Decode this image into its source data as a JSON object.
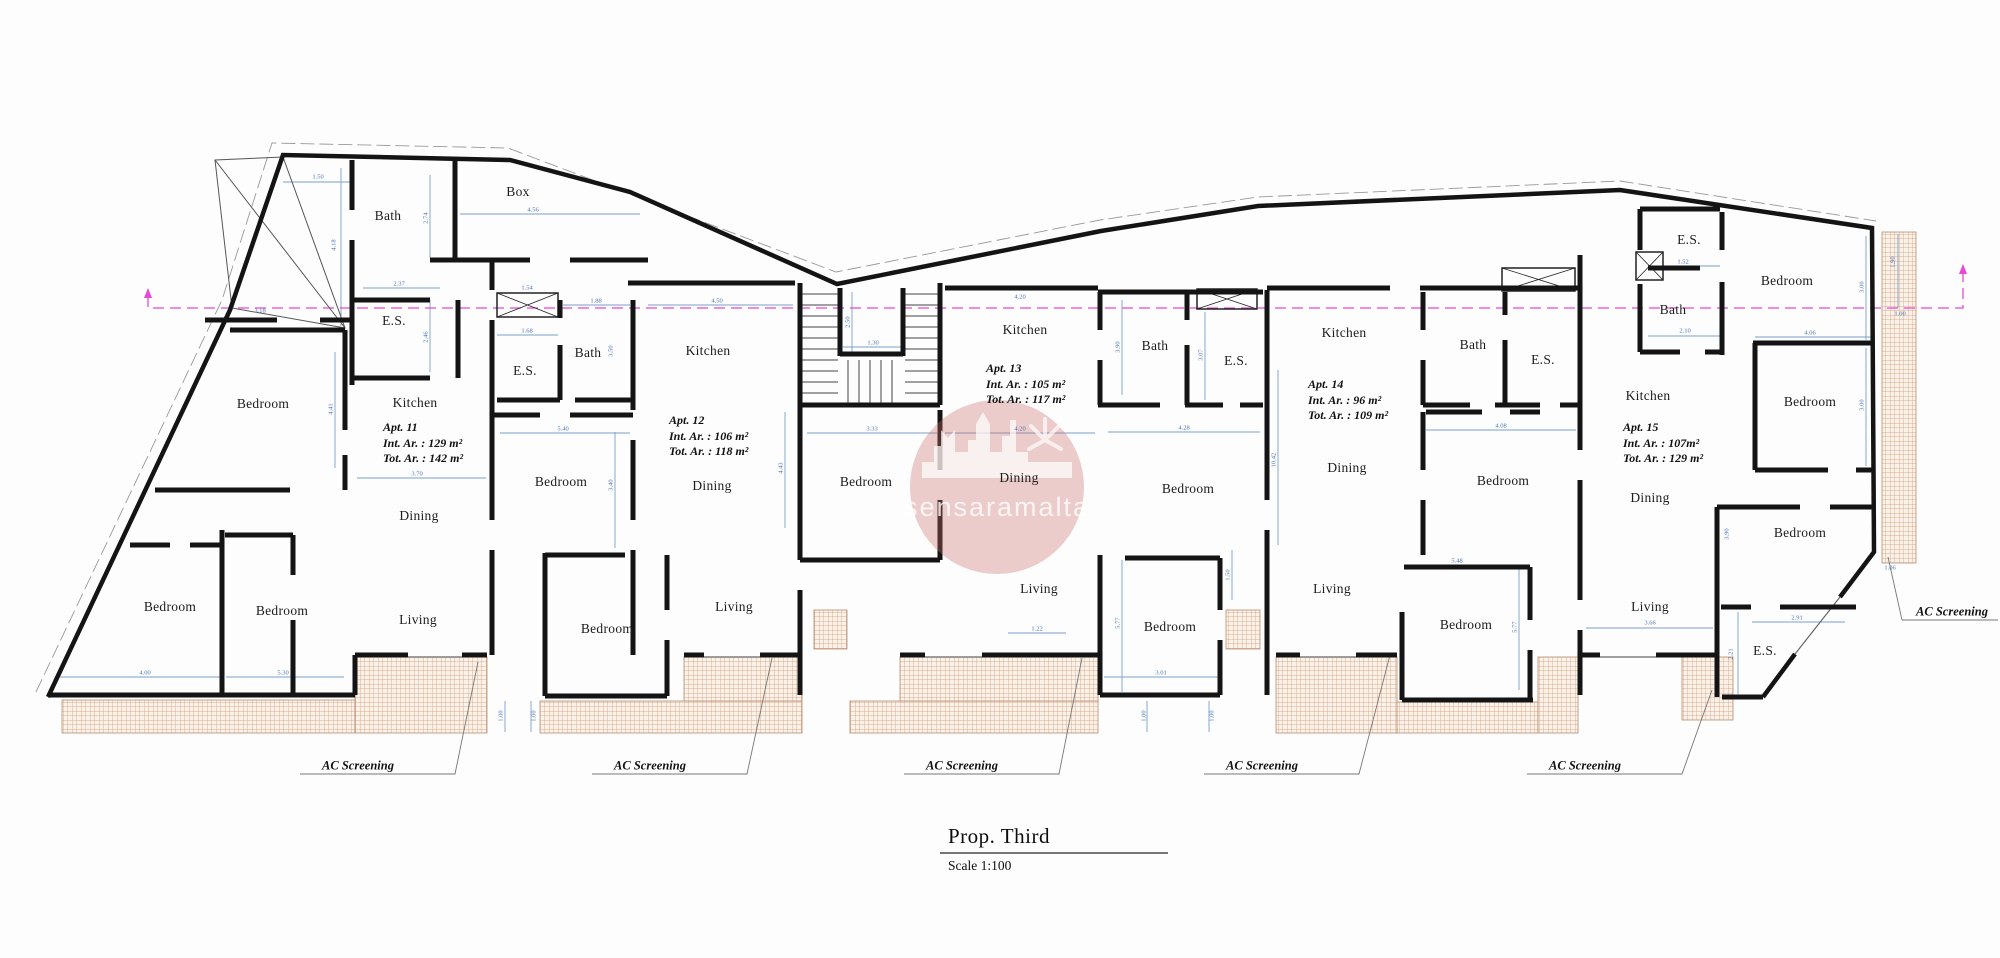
{
  "title_block": {
    "title": "Prop. Third",
    "scale": "Scale 1:100"
  },
  "watermark": {
    "text": "sensaramalta",
    "circle_color": "#c96a6a"
  },
  "colors": {
    "wall": "#141414",
    "dimension": "#4a76b8",
    "datum_magenta": "#e649d6",
    "terrace_hatch": "#cf9b76"
  },
  "apartments": [
    {
      "name": "Apt. 11",
      "int_area": "Int. Ar. : 129 m²",
      "tot_area": "Tot. Ar. : 142 m²",
      "x": 383,
      "y": 420
    },
    {
      "name": "Apt. 12",
      "int_area": "Int. Ar. : 106 m²",
      "tot_area": "Tot. Ar. : 118 m²",
      "x": 669,
      "y": 413
    },
    {
      "name": "Apt. 13",
      "int_area": "Int. Ar. : 105 m²",
      "tot_area": "Tot. Ar. : 117 m²",
      "x": 986,
      "y": 361
    },
    {
      "name": "Apt. 14",
      "int_area": "Int. Ar. : 96 m²",
      "tot_area": "Tot. Ar. : 109 m²",
      "x": 1308,
      "y": 377
    },
    {
      "name": "Apt. 15",
      "int_area": "Int. Ar. : 107m²",
      "tot_area": "Tot. Ar. : 129 m²",
      "x": 1623,
      "y": 420
    }
  ],
  "rooms": [
    {
      "label": "Bath",
      "x": 388,
      "y": 216
    },
    {
      "label": "Box",
      "x": 518,
      "y": 192
    },
    {
      "label": "E.S.",
      "x": 394,
      "y": 321
    },
    {
      "label": "Bedroom",
      "x": 263,
      "y": 404
    },
    {
      "label": "Kitchen",
      "x": 415,
      "y": 403
    },
    {
      "label": "Dining",
      "x": 419,
      "y": 516
    },
    {
      "label": "Bedroom",
      "x": 170,
      "y": 607
    },
    {
      "label": "Bedroom",
      "x": 282,
      "y": 611
    },
    {
      "label": "Living",
      "x": 418,
      "y": 620
    },
    {
      "label": "Bath",
      "x": 588,
      "y": 353
    },
    {
      "label": "E.S.",
      "x": 525,
      "y": 371
    },
    {
      "label": "Kitchen",
      "x": 708,
      "y": 351
    },
    {
      "label": "Bedroom",
      "x": 561,
      "y": 482
    },
    {
      "label": "Dining",
      "x": 712,
      "y": 486
    },
    {
      "label": "Bedroom",
      "x": 607,
      "y": 629
    },
    {
      "label": "Living",
      "x": 734,
      "y": 607
    },
    {
      "label": "Kitchen",
      "x": 1025,
      "y": 330
    },
    {
      "label": "Bedroom",
      "x": 866,
      "y": 482
    },
    {
      "label": "Dining",
      "x": 1019,
      "y": 478
    },
    {
      "label": "Bath",
      "x": 1155,
      "y": 346
    },
    {
      "label": "E.S.",
      "x": 1236,
      "y": 361
    },
    {
      "label": "Living",
      "x": 1039,
      "y": 589
    },
    {
      "label": "Bedroom",
      "x": 1170,
      "y": 627
    },
    {
      "label": "Kitchen",
      "x": 1344,
      "y": 333
    },
    {
      "label": "Bath",
      "x": 1473,
      "y": 345
    },
    {
      "label": "E.S.",
      "x": 1543,
      "y": 360
    },
    {
      "label": "Bedroom",
      "x": 1188,
      "y": 489
    },
    {
      "label": "Dining",
      "x": 1347,
      "y": 468
    },
    {
      "label": "Living",
      "x": 1332,
      "y": 589
    },
    {
      "label": "Bedroom",
      "x": 1466,
      "y": 625
    },
    {
      "label": "Kitchen",
      "x": 1648,
      "y": 396
    },
    {
      "label": "Bath",
      "x": 1673,
      "y": 310
    },
    {
      "label": "E.S.",
      "x": 1689,
      "y": 240
    },
    {
      "label": "Bedroom",
      "x": 1787,
      "y": 281
    },
    {
      "label": "Bedroom",
      "x": 1810,
      "y": 402
    },
    {
      "label": "Bedroom",
      "x": 1503,
      "y": 481
    },
    {
      "label": "Dining",
      "x": 1650,
      "y": 498
    },
    {
      "label": "Living",
      "x": 1650,
      "y": 607
    },
    {
      "label": "Bedroom",
      "x": 1800,
      "y": 533
    },
    {
      "label": "E.S.",
      "x": 1765,
      "y": 651
    }
  ],
  "ac_screening_labels": [
    {
      "label": "AC Screening",
      "x": 358,
      "y": 766
    },
    {
      "label": "AC Screening",
      "x": 650,
      "y": 766
    },
    {
      "label": "AC Screening",
      "x": 962,
      "y": 766
    },
    {
      "label": "AC Screening",
      "x": 1262,
      "y": 766
    },
    {
      "label": "AC Screening",
      "x": 1585,
      "y": 766
    },
    {
      "label": "AC Screening",
      "x": 1952,
      "y": 612
    }
  ],
  "dimensions": [
    {
      "v": "1.50",
      "x": 318,
      "y": 177,
      "r": 0
    },
    {
      "v": "4.56",
      "x": 533,
      "y": 210,
      "r": 0
    },
    {
      "v": "2.74",
      "x": 426,
      "y": 218,
      "r": 1
    },
    {
      "v": "4.18",
      "x": 334,
      "y": 245,
      "r": 1
    },
    {
      "v": "2.37",
      "x": 399,
      "y": 284,
      "r": 0
    },
    {
      "v": "2.46",
      "x": 426,
      "y": 337,
      "r": 1
    },
    {
      "v": "3.18",
      "x": 260,
      "y": 311,
      "r": 0
    },
    {
      "v": "1.54",
      "x": 527,
      "y": 288,
      "r": 0
    },
    {
      "v": "1.88",
      "x": 596,
      "y": 301,
      "r": 0
    },
    {
      "v": "4.50",
      "x": 717,
      "y": 301,
      "r": 0
    },
    {
      "v": "1.68",
      "x": 527,
      "y": 331,
      "r": 0
    },
    {
      "v": "3.50",
      "x": 611,
      "y": 351,
      "r": 1
    },
    {
      "v": "5.40",
      "x": 563,
      "y": 429,
      "r": 0
    },
    {
      "v": "3.40",
      "x": 611,
      "y": 485,
      "r": 1
    },
    {
      "v": "4.41",
      "x": 331,
      "y": 409,
      "r": 1
    },
    {
      "v": "3.70",
      "x": 417,
      "y": 474,
      "r": 0
    },
    {
      "v": "4.00",
      "x": 145,
      "y": 673,
      "r": 0
    },
    {
      "v": "5.30",
      "x": 283,
      "y": 673,
      "r": 0
    },
    {
      "v": "4.43",
      "x": 781,
      "y": 468,
      "r": 1
    },
    {
      "v": "2.50",
      "x": 848,
      "y": 322,
      "r": 1
    },
    {
      "v": "1.30",
      "x": 873,
      "y": 343,
      "r": 0
    },
    {
      "v": "4.20",
      "x": 1020,
      "y": 297,
      "r": 0
    },
    {
      "v": "4.20",
      "x": 1020,
      "y": 429,
      "r": 0
    },
    {
      "v": "3.33",
      "x": 872,
      "y": 429,
      "r": 0
    },
    {
      "v": "3.90",
      "x": 1118,
      "y": 347,
      "r": 1
    },
    {
      "v": "3.07",
      "x": 1201,
      "y": 355,
      "r": 1
    },
    {
      "v": "4.28",
      "x": 1184,
      "y": 428,
      "r": 0
    },
    {
      "v": "10.42",
      "x": 1274,
      "y": 460,
      "r": 1
    },
    {
      "v": "5.77",
      "x": 1118,
      "y": 623,
      "r": 1
    },
    {
      "v": "3.01",
      "x": 1161,
      "y": 673,
      "r": 0
    },
    {
      "v": "1.22",
      "x": 1037,
      "y": 629,
      "r": 0
    },
    {
      "v": "1.50",
      "x": 1228,
      "y": 575,
      "r": 1
    },
    {
      "v": "1.00",
      "x": 501,
      "y": 716,
      "r": 1
    },
    {
      "v": "1.00",
      "x": 534,
      "y": 716,
      "r": 1
    },
    {
      "v": "1.00",
      "x": 1144,
      "y": 716,
      "r": 1
    },
    {
      "v": "1.00",
      "x": 1212,
      "y": 716,
      "r": 1
    },
    {
      "v": "4.08",
      "x": 1501,
      "y": 426,
      "r": 0
    },
    {
      "v": "5.48",
      "x": 1457,
      "y": 561,
      "r": 0
    },
    {
      "v": "5.77",
      "x": 1515,
      "y": 627,
      "r": 1
    },
    {
      "v": "3.66",
      "x": 1650,
      "y": 623,
      "r": 0
    },
    {
      "v": "2.10",
      "x": 1685,
      "y": 331,
      "r": 0
    },
    {
      "v": "1.52",
      "x": 1683,
      "y": 262,
      "r": 0
    },
    {
      "v": "1.90",
      "x": 1893,
      "y": 262,
      "r": 1
    },
    {
      "v": "1.00",
      "x": 1900,
      "y": 314,
      "r": 0
    },
    {
      "v": "3.00",
      "x": 1862,
      "y": 287,
      "r": 1
    },
    {
      "v": "3.00",
      "x": 1862,
      "y": 405,
      "r": 1
    },
    {
      "v": "4.06",
      "x": 1810,
      "y": 333,
      "r": 0
    },
    {
      "v": "1.06",
      "x": 1890,
      "y": 568,
      "r": 0
    },
    {
      "v": "2.91",
      "x": 1797,
      "y": 618,
      "r": 0
    },
    {
      "v": "2.21",
      "x": 1731,
      "y": 654,
      "r": 1
    },
    {
      "v": "3.90",
      "x": 1727,
      "y": 534,
      "r": 1
    }
  ]
}
